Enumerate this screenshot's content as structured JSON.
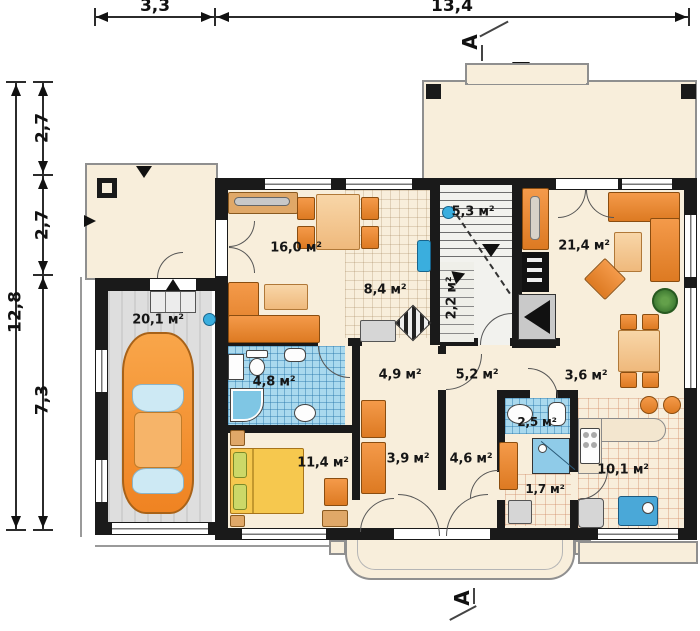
{
  "title": "Ground floor plan",
  "dimensions": {
    "top": [
      "3,3",
      "13,4"
    ],
    "left_total": "12,8",
    "left_segments": [
      "2,7",
      "2,7",
      "7,3"
    ]
  },
  "section_marker": "A",
  "rooms": [
    {
      "name": "living-dining",
      "area": "16,0 м²"
    },
    {
      "name": "staircase",
      "area": "5,3 м²"
    },
    {
      "name": "living-room",
      "area": "21,4 м²"
    },
    {
      "name": "hallway",
      "area": "8,4 м²"
    },
    {
      "name": "under-stairs",
      "area": "2,2 м²"
    },
    {
      "name": "garage",
      "area": "20,1 м²"
    },
    {
      "name": "bathroom",
      "area": "4,8 м²"
    },
    {
      "name": "corridor",
      "area": "4,9 м²"
    },
    {
      "name": "lobby",
      "area": "5,2 м²"
    },
    {
      "name": "passage",
      "area": "3,6 м²"
    },
    {
      "name": "wc",
      "area": "2,5 м²"
    },
    {
      "name": "bedroom",
      "area": "11,4 м²"
    },
    {
      "name": "corridor-2",
      "area": "3,9 м²"
    },
    {
      "name": "entry-hall",
      "area": "4,6 м²"
    },
    {
      "name": "kitchen",
      "area": "10,1 м²"
    },
    {
      "name": "pantry",
      "area": "1,7 м²"
    }
  ],
  "colors": {
    "walls": "#1a1a1a",
    "floor_cream": "#f8eedb",
    "furniture_orange": "#e8882f",
    "furniture_light": "#f4c488",
    "tile_blue": "#a9d9ee",
    "garage_floor": "#d9d9d9",
    "bed_yellow": "#f6c84e",
    "radiator_blue": "#3aaede",
    "outline_gray": "#8f8f8f"
  }
}
